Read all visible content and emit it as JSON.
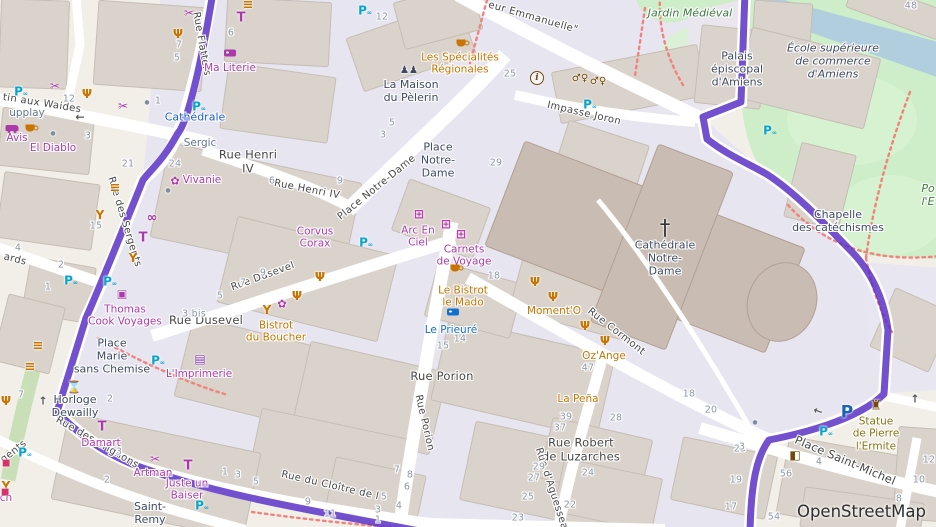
{
  "map": {
    "attribution": "OpenStreetMap",
    "theme": {
      "route": "#5b33c6",
      "pedestrian": "#e6e5f0",
      "park": "#cdeec8",
      "water": "#b0cedd",
      "building": "#dad3cb",
      "cathedral": "#c9bcb2",
      "street_fill": "#ffffff",
      "crossing_dots": "#f0837d",
      "shop": "#ac39ac",
      "food": "#c77400",
      "hotel": "#116ed2",
      "transit": "#1a5fd0",
      "place": "#3e4a63",
      "park_label": "#3c7a3f",
      "memorial": "#857413",
      "street_label": "#474747",
      "house_number": "#8c96a6",
      "parking": "#1a62b8",
      "bicycle_parking": "#09a4cb",
      "amenity_brown": "#734a08"
    },
    "streets": [
      {
        "lines": [
          "tin aux Waides"
        ],
        "x": 42,
        "y": 104,
        "rot": 9
      },
      {
        "lines": [
          "Rue des Sergents"
        ],
        "x": 124,
        "y": 222,
        "rot": 73
      },
      {
        "lines": [
          "Rue Flatters"
        ],
        "x": 201,
        "y": 44,
        "rot": 80
      },
      {
        "lines": [
          "ards"
        ],
        "x": 15,
        "y": 260,
        "rot": 14
      },
      {
        "lines": [
          "Rue Henri",
          "IV"
        ],
        "x": 248,
        "y": 162,
        "rot": 0,
        "big": true
      },
      {
        "lines": [
          "Rue Henri IV"
        ],
        "x": 307,
        "y": 190,
        "rot": 11
      },
      {
        "lines": [
          "Place Notre-Dame"
        ],
        "x": 377,
        "y": 188,
        "rot": -39
      },
      {
        "lines": [
          "eur Emmanuelle\""
        ],
        "x": 533,
        "y": 18,
        "rot": 16
      },
      {
        "lines": [
          "Impasse Joron"
        ],
        "x": 584,
        "y": 114,
        "rot": 13
      },
      {
        "lines": [
          "Rue Dusevel"
        ],
        "x": 263,
        "y": 277,
        "rot": -20
      },
      {
        "lines": [
          "Rue Dusevel"
        ],
        "x": 206,
        "y": 321,
        "rot": 0,
        "big": true
      },
      {
        "lines": [
          "Rue Porion"
        ],
        "x": 442,
        "y": 377,
        "rot": 0,
        "big": true
      },
      {
        "lines": [
          "Rue Porion"
        ],
        "x": 424,
        "y": 423,
        "rot": 77
      },
      {
        "lines": [
          "Rue Cormont"
        ],
        "x": 616,
        "y": 332,
        "rot": 38
      },
      {
        "lines": [
          "Rue Robert",
          "de Luzarches"
        ],
        "x": 581,
        "y": 450,
        "rot": 0,
        "big": true
      },
      {
        "lines": [
          "Rue d'Aguesseau"
        ],
        "x": 552,
        "y": 492,
        "rot": 72
      },
      {
        "lines": [
          "Place Saint-Michel"
        ],
        "x": 845,
        "y": 461,
        "rot": 23,
        "big": true
      },
      {
        "lines": [
          "Rue du Cloître de l"
        ],
        "x": 330,
        "y": 486,
        "rot": 13
      },
      {
        "lines": [
          "Rue des Crignons"
        ],
        "x": 97,
        "y": 443,
        "rot": 30
      },
      {
        "lines": [
          "gents"
        ],
        "x": 14,
        "y": 452,
        "rot": -38
      }
    ],
    "places": [
      {
        "lines": [
          "Place",
          "Notre-",
          "Dame"
        ],
        "x": 438,
        "y": 161
      },
      {
        "lines": [
          "Place",
          "Marie",
          "sans Chemise"
        ],
        "x": 112,
        "y": 357
      },
      {
        "lines": [
          "Horloge",
          "Dewailly"
        ],
        "x": 75,
        "y": 407
      },
      {
        "lines": [
          "La Maison",
          "du Pèlerin"
        ],
        "x": 411,
        "y": 92
      },
      {
        "lines": [
          "Cathédrale",
          "Notre-",
          "Dame"
        ],
        "x": 665,
        "y": 259
      },
      {
        "lines": [
          "Chapelle",
          "des catéchismes"
        ],
        "x": 838,
        "y": 222
      },
      {
        "lines": [
          "Palais",
          "épiscopal",
          "d'Amiens"
        ],
        "x": 737,
        "y": 70
      },
      {
        "lines": [
          "École supérieure",
          "de commerce",
          "d'Amiens"
        ],
        "x": 833,
        "y": 62,
        "italic": true
      },
      {
        "lines": [
          "Saint-",
          "Remy"
        ],
        "x": 150,
        "y": 514
      }
    ],
    "parks": [
      {
        "lines": [
          "Jardin Médiéval"
        ],
        "x": 690,
        "y": 14
      },
      {
        "lines": [
          "Po",
          "l'E"
        ],
        "x": 928,
        "y": 196
      }
    ],
    "pois": [
      {
        "kind": "shop",
        "lines": [
          "Ma Literie"
        ],
        "x": 230,
        "y": 68
      },
      {
        "kind": "shop",
        "lines": [
          "Vivanie"
        ],
        "x": 202,
        "y": 180
      },
      {
        "kind": "shop",
        "lines": [
          "Avis"
        ],
        "x": 17,
        "y": 138
      },
      {
        "kind": "shop",
        "lines": [
          "El Diablo"
        ],
        "x": 53,
        "y": 148
      },
      {
        "kind": "shop",
        "lines": [
          "Thomas",
          "Cook Voyages"
        ],
        "x": 125,
        "y": 316
      },
      {
        "kind": "shop",
        "lines": [
          "Corvus",
          "Corax"
        ],
        "x": 315,
        "y": 238
      },
      {
        "kind": "shop",
        "lines": [
          "Arc En",
          "Ciel"
        ],
        "x": 418,
        "y": 237
      },
      {
        "kind": "shop",
        "lines": [
          "Carnets",
          "de Voyage"
        ],
        "x": 464,
        "y": 256
      },
      {
        "kind": "shop",
        "lines": [
          "L'Imprimerie"
        ],
        "x": 199,
        "y": 374
      },
      {
        "kind": "shop",
        "lines": [
          "Damart"
        ],
        "x": 101,
        "y": 443
      },
      {
        "kind": "shop",
        "lines": [
          "Artman"
        ],
        "x": 153,
        "y": 473
      },
      {
        "kind": "shop",
        "lines": [
          "Juste un",
          "Baiser"
        ],
        "x": 187,
        "y": 490
      },
      {
        "kind": "shop",
        "lines": [
          "ch"
        ],
        "x": 6,
        "y": 498
      },
      {
        "kind": "food",
        "lines": [
          "Les Spécialités",
          "Régionales"
        ],
        "x": 460,
        "y": 64
      },
      {
        "kind": "food",
        "lines": [
          "Bistrot",
          "du Boucher"
        ],
        "x": 276,
        "y": 332
      },
      {
        "kind": "food",
        "lines": [
          "Le Bistrot",
          "le Mado"
        ],
        "x": 463,
        "y": 297
      },
      {
        "kind": "food",
        "lines": [
          "Moment'O"
        ],
        "x": 554,
        "y": 311
      },
      {
        "kind": "food",
        "lines": [
          "Oz'Ange"
        ],
        "x": 604,
        "y": 356
      },
      {
        "kind": "food",
        "lines": [
          "La Peña"
        ],
        "x": 578,
        "y": 399
      },
      {
        "kind": "hotel",
        "lines": [
          "Le Prieuré"
        ],
        "x": 451,
        "y": 330
      },
      {
        "kind": "transit",
        "lines": [
          "Cathédrale"
        ],
        "x": 195,
        "y": 118
      },
      {
        "kind": "muted",
        "lines": [
          "Sergic"
        ],
        "x": 200,
        "y": 143
      },
      {
        "kind": "muted",
        "lines": [
          "upplay"
        ],
        "x": 27,
        "y": 113
      },
      {
        "kind": "memorial",
        "lines": [
          "Statue",
          "de Pierre",
          "l'Ermite"
        ],
        "x": 876,
        "y": 434
      }
    ],
    "numbers": [
      {
        "t": "12",
        "x": 382,
        "y": 17
      },
      {
        "t": "12",
        "x": 69,
        "y": 99
      },
      {
        "t": "3",
        "x": 88,
        "y": 136
      },
      {
        "t": "21",
        "x": 128,
        "y": 164
      },
      {
        "t": "24",
        "x": 175,
        "y": 164
      },
      {
        "t": "1",
        "x": 158,
        "y": 101
      },
      {
        "t": "7",
        "x": 179,
        "y": 45
      },
      {
        "t": "5",
        "x": 177,
        "y": 58
      },
      {
        "t": "6",
        "x": 231,
        "y": 33
      },
      {
        "t": "15",
        "x": 96,
        "y": 226
      },
      {
        "t": "4",
        "x": 18,
        "y": 248
      },
      {
        "t": "2",
        "x": 61,
        "y": 265
      },
      {
        "t": "1",
        "x": 48,
        "y": 287
      },
      {
        "t": "6",
        "x": 272,
        "y": 181
      },
      {
        "t": "9",
        "x": 263,
        "y": 273
      },
      {
        "t": "7",
        "x": 243,
        "y": 283
      },
      {
        "t": "5",
        "x": 220,
        "y": 296
      },
      {
        "t": "3 bis",
        "x": 194,
        "y": 314
      },
      {
        "t": "25",
        "x": 510,
        "y": 74
      },
      {
        "t": "29",
        "x": 496,
        "y": 163
      },
      {
        "t": "5",
        "x": 392,
        "y": 123
      },
      {
        "t": "3",
        "x": 383,
        "y": 135
      },
      {
        "t": "9",
        "x": 340,
        "y": 181
      },
      {
        "t": "18",
        "x": 494,
        "y": 276
      },
      {
        "t": "15",
        "x": 443,
        "y": 346
      },
      {
        "t": "14",
        "x": 460,
        "y": 339
      },
      {
        "t": "47",
        "x": 588,
        "y": 368
      },
      {
        "t": "39",
        "x": 566,
        "y": 417
      },
      {
        "t": "37",
        "x": 560,
        "y": 428
      },
      {
        "t": "28",
        "x": 616,
        "y": 418
      },
      {
        "t": "29",
        "x": 539,
        "y": 467
      },
      {
        "t": "27",
        "x": 534,
        "y": 478
      },
      {
        "t": "25",
        "x": 528,
        "y": 497
      },
      {
        "t": "23",
        "x": 518,
        "y": 518
      },
      {
        "t": "24",
        "x": 588,
        "y": 473
      },
      {
        "t": "22",
        "x": 570,
        "y": 505
      },
      {
        "t": "11",
        "x": 330,
        "y": 514
      },
      {
        "t": "8",
        "x": 410,
        "y": 475
      },
      {
        "t": "7",
        "x": 397,
        "y": 470
      },
      {
        "t": "6",
        "x": 407,
        "y": 487
      },
      {
        "t": "5",
        "x": 384,
        "y": 497
      },
      {
        "t": "4",
        "x": 399,
        "y": 506
      },
      {
        "t": "18",
        "x": 689,
        "y": 394
      },
      {
        "t": "20",
        "x": 711,
        "y": 410
      },
      {
        "t": "23",
        "x": 740,
        "y": 449
      },
      {
        "t": "19",
        "x": 736,
        "y": 480
      },
      {
        "t": "17",
        "x": 731,
        "y": 507
      },
      {
        "t": "56",
        "x": 786,
        "y": 474
      },
      {
        "t": "54",
        "x": 774,
        "y": 517
      },
      {
        "t": "4",
        "x": 819,
        "y": 462
      },
      {
        "t": "10",
        "x": 919,
        "y": 480
      },
      {
        "t": "12",
        "x": 929,
        "y": 460
      },
      {
        "t": "8",
        "x": 899,
        "y": 499
      },
      {
        "t": "48",
        "x": 911,
        "y": 6
      },
      {
        "t": "3",
        "x": 742,
        "y": 447
      },
      {
        "t": "1",
        "x": 225,
        "y": 472
      },
      {
        "t": "3",
        "x": 238,
        "y": 475
      },
      {
        "t": "5",
        "x": 256,
        "y": 482
      },
      {
        "t": "9",
        "x": 308,
        "y": 502
      },
      {
        "t": "3",
        "x": 378,
        "y": 510
      },
      {
        "t": "1",
        "x": 378,
        "y": 520
      },
      {
        "t": "7",
        "x": 21,
        "y": 395
      },
      {
        "t": "2",
        "x": 110,
        "y": 399
      },
      {
        "t": "3",
        "x": 119,
        "y": 452
      },
      {
        "t": "2",
        "x": 107,
        "y": 480
      }
    ],
    "icons": [
      {
        "kind": "scissors",
        "x": 189,
        "y": 13
      },
      {
        "kind": "burger",
        "x": 248,
        "y": 5
      },
      {
        "kind": "shirt",
        "x": 241,
        "y": 18
      },
      {
        "kind": "restaurant",
        "x": 178,
        "y": 34
      },
      {
        "kind": "bed",
        "x": 230,
        "y": 53,
        "v": "shop"
      },
      {
        "kind": "scissors",
        "x": 55,
        "y": 86
      },
      {
        "kind": "restaurant",
        "x": 87,
        "y": 94
      },
      {
        "kind": "scissors",
        "x": 123,
        "y": 106
      },
      {
        "kind": "dot",
        "x": 147,
        "y": 103
      },
      {
        "kind": "car",
        "x": 12,
        "y": 128
      },
      {
        "kind": "cup",
        "x": 30,
        "y": 128
      },
      {
        "kind": "dot",
        "x": 53,
        "y": 134
      },
      {
        "kind": "bikep",
        "x": 21,
        "y": 91
      },
      {
        "kind": "bikep",
        "x": 365,
        "y": 10
      },
      {
        "kind": "flower",
        "x": 175,
        "y": 181
      },
      {
        "kind": "dot",
        "x": 168,
        "y": 191
      },
      {
        "kind": "burger",
        "x": 115,
        "y": 188
      },
      {
        "kind": "bar",
        "x": 100,
        "y": 215
      },
      {
        "kind": "glasses",
        "x": 152,
        "y": 218
      },
      {
        "kind": "shirt",
        "x": 143,
        "y": 238
      },
      {
        "kind": "bar",
        "x": 133,
        "y": 258
      },
      {
        "kind": "travel",
        "x": 122,
        "y": 294
      },
      {
        "kind": "bikep",
        "x": 71,
        "y": 280
      },
      {
        "kind": "bikep",
        "x": 110,
        "y": 281
      },
      {
        "kind": "people",
        "x": 409,
        "y": 71
      },
      {
        "kind": "cup",
        "x": 461,
        "y": 43
      },
      {
        "kind": "info",
        "x": 537,
        "y": 78
      },
      {
        "kind": "toilets",
        "x": 580,
        "y": 79
      },
      {
        "kind": "toilets",
        "x": 598,
        "y": 82
      },
      {
        "kind": "bikep",
        "x": 590,
        "y": 104
      },
      {
        "kind": "bikep",
        "x": 770,
        "y": 130
      },
      {
        "kind": "bikep",
        "x": 199,
        "y": 106
      },
      {
        "kind": "gift",
        "x": 419,
        "y": 214
      },
      {
        "kind": "gift",
        "x": 446,
        "y": 224
      },
      {
        "kind": "gift",
        "x": 461,
        "y": 234
      },
      {
        "kind": "bikep",
        "x": 366,
        "y": 242
      },
      {
        "kind": "cup",
        "x": 455,
        "y": 268
      },
      {
        "kind": "bed",
        "x": 453,
        "y": 312,
        "v": "hotel"
      },
      {
        "kind": "restaurant",
        "x": 535,
        "y": 282
      },
      {
        "kind": "restaurant",
        "x": 553,
        "y": 297
      },
      {
        "kind": "restaurant",
        "x": 585,
        "y": 326
      },
      {
        "kind": "restaurant",
        "x": 605,
        "y": 341
      },
      {
        "kind": "restaurant",
        "x": 320,
        "y": 277
      },
      {
        "kind": "restaurant",
        "x": 297,
        "y": 296
      },
      {
        "kind": "bar",
        "x": 267,
        "y": 310
      },
      {
        "kind": "flower",
        "x": 282,
        "y": 304
      },
      {
        "kind": "book",
        "x": 200,
        "y": 359
      },
      {
        "kind": "clock",
        "x": 74,
        "y": 387
      },
      {
        "kind": "shirt",
        "x": 102,
        "y": 427
      },
      {
        "kind": "scissors",
        "x": 155,
        "y": 459
      },
      {
        "kind": "shirt",
        "x": 188,
        "y": 466
      },
      {
        "kind": "restaurant",
        "x": 6,
        "y": 401
      },
      {
        "kind": "bar",
        "x": 6,
        "y": 486
      },
      {
        "kind": "burger",
        "x": 38,
        "y": 346
      },
      {
        "kind": "burger",
        "x": 30,
        "y": 367
      },
      {
        "kind": "bikep",
        "x": 25,
        "y": 452
      },
      {
        "kind": "bikep",
        "x": 158,
        "y": 360
      },
      {
        "kind": "bikep",
        "x": 202,
        "y": 505
      },
      {
        "kind": "cross",
        "x": 665,
        "y": 228
      },
      {
        "kind": "statue",
        "x": 876,
        "y": 406
      },
      {
        "kind": "door",
        "x": 795,
        "y": 455
      },
      {
        "kind": "parking",
        "x": 847,
        "y": 413
      },
      {
        "kind": "bikep",
        "x": 826,
        "y": 431
      },
      {
        "kind": "arrow-left",
        "x": 80,
        "y": 117
      },
      {
        "kind": "arrow-up",
        "x": 43,
        "y": 401
      },
      {
        "kind": "arrow-up",
        "x": 915,
        "y": 399
      },
      {
        "kind": "arrow-left",
        "x": 818,
        "y": 411,
        "rot": 20
      },
      {
        "kind": "dot",
        "x": 755,
        "y": 423
      },
      {
        "kind": "marker",
        "x": 6,
        "y": 464
      },
      {
        "kind": "marker",
        "x": 5,
        "y": 493
      }
    ]
  }
}
